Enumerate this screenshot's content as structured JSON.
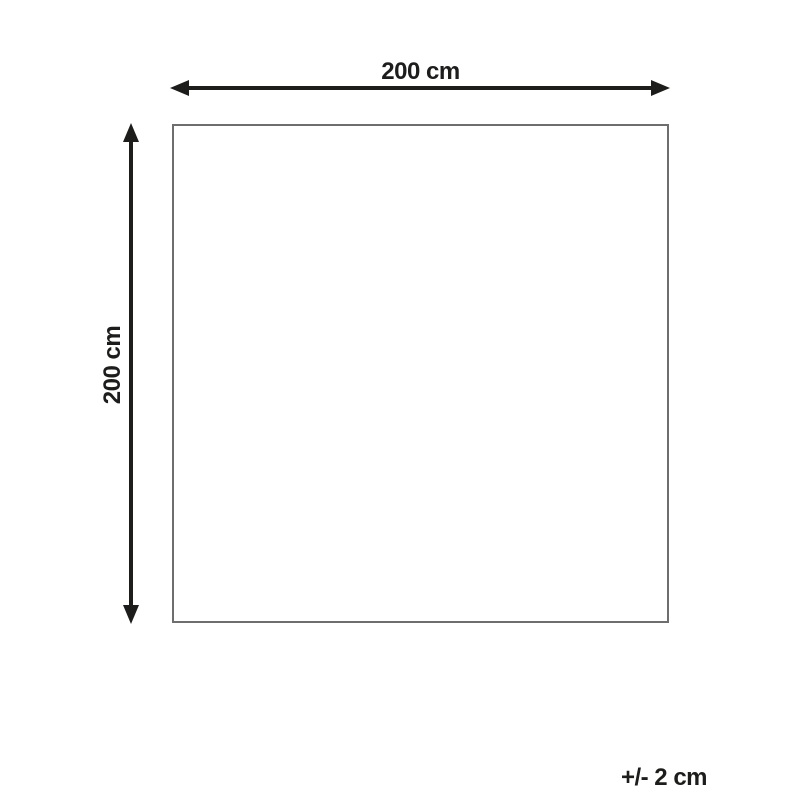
{
  "diagram": {
    "type": "dimension-diagram",
    "width_label": "200 cm",
    "height_label": "200 cm",
    "tolerance_label": "+/- 2 cm",
    "width_cm": 200,
    "height_cm": 200,
    "tolerance_cm": 2,
    "colors": {
      "background": "#ffffff",
      "arrow": "#1d1d1b",
      "outline": "#6e6e6e",
      "text": "#1d1d1b"
    }
  }
}
